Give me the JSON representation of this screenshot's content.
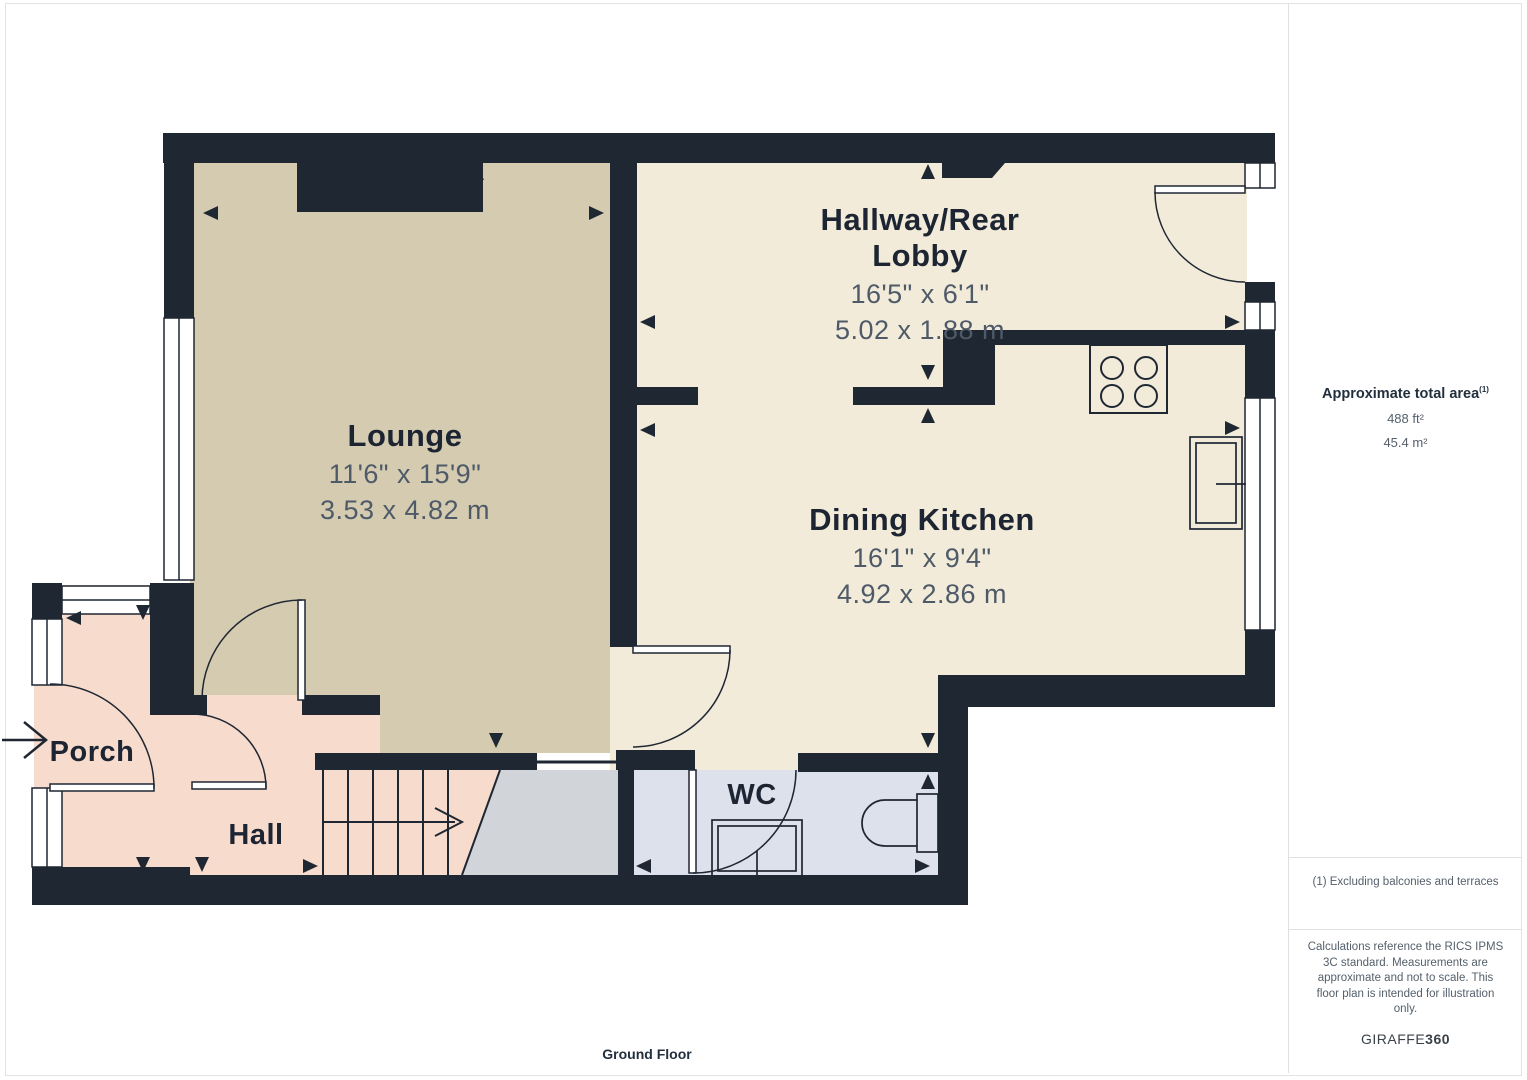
{
  "floor_label": "Ground Floor",
  "rooms": [
    {
      "name": "Lounge",
      "imperial": "11'6\" x 15'9\"",
      "metric": "3.53 x 4.82 m"
    },
    {
      "name": "Hallway/Rear Lobby",
      "imperial": "16'5\" x 6'1\"",
      "metric": "5.02 x 1.88 m"
    },
    {
      "name": "Dining Kitchen",
      "imperial": "16'1\" x 9'4\"",
      "metric": "4.92 x 2.86 m"
    },
    {
      "name": "Porch"
    },
    {
      "name": "Hall"
    },
    {
      "name": "WC"
    }
  ],
  "sidebar": {
    "area_title": "Approximate total area",
    "area_ref": "(1)",
    "area_ft": "488 ft²",
    "area_m": "45.4 m²",
    "footnote": "(1) Excluding balconies and terraces",
    "disclaimer": "Calculations reference the RICS IPMS 3C standard. Measurements are approximate and not to scale. This floor plan is intended for illustration only.",
    "brand_normal": "GIRAFFE",
    "brand_bold": "360"
  },
  "colors": {
    "wall": "#1f2733",
    "lounge_floor": "#d5cbb0",
    "kitchen_floor": "#f2ebd9",
    "porch_floor": "#f7dcce",
    "hall_floor": "#f7dcce",
    "wc_floor": "#dde1ec",
    "stair_void": "#d1d4d9",
    "dim_text": "#4e5a68",
    "label_text": "#1d2533"
  }
}
